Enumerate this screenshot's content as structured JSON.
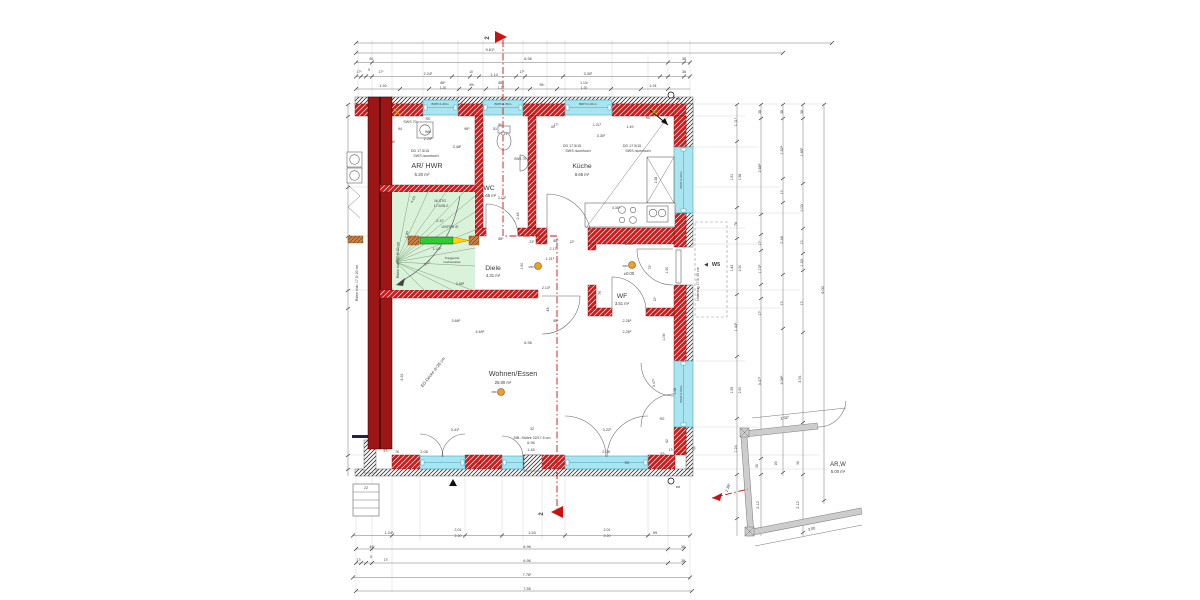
{
  "colors": {
    "wall_red": "#cf1b1b",
    "party_wall": "#9c1616",
    "window_cyan": "#a9e5f0",
    "window_frame": "#43a7bd",
    "stair_green": "#d9f2d9",
    "lintel_green": "#2ecc2e",
    "lintel_yellow": "#ffd400",
    "bearing_brown": "#c8834a",
    "smoke_detector_orange": "#f09e2e",
    "section_red": "#cc1111",
    "fragment_wall_gray": "#cdcdcd",
    "dim_line": "#666666",
    "text": "#3a3a3a"
  },
  "labels": {
    "rooms": [
      {
        "t": "AR/ HWR",
        "x": 427,
        "y": 168,
        "s": 7.2
      },
      {
        "t": "6.20 m²",
        "x": 422,
        "y": 176,
        "s": 4.4
      },
      {
        "t": "WC",
        "x": 489,
        "y": 190,
        "s": 6.8
      },
      {
        "t": "1.65 m²",
        "x": 489,
        "y": 197,
        "s": 4.2
      },
      {
        "t": "Küche",
        "x": 582,
        "y": 168,
        "s": 6.8
      },
      {
        "t": "8.66 m²",
        "x": 582,
        "y": 176,
        "s": 4.2
      },
      {
        "t": "Diele",
        "x": 493,
        "y": 270,
        "s": 6.8
      },
      {
        "t": "4.31 m²",
        "x": 493,
        "y": 277,
        "s": 4.2
      },
      {
        "t": "WF",
        "x": 622,
        "y": 298,
        "s": 6.8
      },
      {
        "t": "3.51 m²",
        "x": 622,
        "y": 305,
        "s": 4.2
      },
      {
        "t": "Wohnen/Essen",
        "x": 513,
        "y": 376,
        "s": 7.2
      },
      {
        "t": "25.90 m²",
        "x": 503,
        "y": 384,
        "s": 4.2
      },
      {
        "t": "AR,W",
        "x": 838,
        "y": 466,
        "s": 6
      },
      {
        "t": "5.00 m²",
        "x": 838,
        "y": 473,
        "s": 4.2
      }
    ],
    "annotations": [
      {
        "t": "SWS 70",
        "x": 410,
        "y": 123,
        "s": 3.6
      },
      {
        "t": "RO",
        "x": 428,
        "y": 120,
        "s": 3.2
      },
      {
        "t": "WM",
        "x": 428,
        "y": 133,
        "s": 3.4
      },
      {
        "t": "DD 17.5/15",
        "x": 420,
        "y": 152,
        "s": 3.6
      },
      {
        "t": "SWS raumhoch",
        "x": 426,
        "y": 157,
        "s": 3.6
      },
      {
        "t": "DD 17.5/15",
        "x": 572,
        "y": 147,
        "s": 3.6
      },
      {
        "t": "SWS raumhoch",
        "x": 578,
        "y": 152,
        "s": 3.6
      },
      {
        "t": "DD 17.5/15",
        "x": 632,
        "y": 147,
        "s": 3.6
      },
      {
        "t": "SWS raumhoch",
        "x": 638,
        "y": 152,
        "s": 3.6
      },
      {
        "t": "SWS 70",
        "x": 520,
        "y": 160,
        "s": 3.2
      },
      {
        "t": "BRH=1.00m",
        "x": 440,
        "y": 105,
        "s": 3.1
      },
      {
        "t": "BRH=1.50m",
        "x": 503,
        "y": 105,
        "s": 3.1
      },
      {
        "t": "BRH=1.00 m",
        "x": 588,
        "y": 105,
        "s": 3.1
      },
      {
        "t": "BRH=1.00m",
        "x": 682,
        "y": 180,
        "s": 3.1,
        "r": -90
      },
      {
        "t": "BRH=1.00m",
        "x": 682,
        "y": 394,
        "s": 3.1,
        "r": -90
      },
      {
        "t": "RO",
        "x": 648,
        "y": 119,
        "s": 3.2
      },
      {
        "t": "RO",
        "x": 479,
        "y": 464,
        "s": 3.2
      },
      {
        "t": "RO",
        "x": 627,
        "y": 464,
        "s": 3.2
      },
      {
        "t": "RO",
        "x": 662,
        "y": 420,
        "s": 3.2
      },
      {
        "t": "16 STG",
        "x": 440,
        "y": 202,
        "s": 3.5
      },
      {
        "t": "17.9/26.0",
        "x": 441,
        "y": 207,
        "s": 3.5
      },
      {
        "t": "2.47",
        "x": 440,
        "y": 222,
        "s": 3.8
      },
      {
        "t": "UV/FBH /E",
        "x": 450,
        "y": 228,
        "s": 3.5
      },
      {
        "t": "Traggerüst",
        "x": 452,
        "y": 259,
        "s": 3.1
      },
      {
        "t": "nachweisbar",
        "x": 452,
        "y": 263,
        "s": 3.1
      },
      {
        "t": "Rähm b/d= 17.5/ 20 cm",
        "x": 358,
        "y": 283,
        "s": 3.5,
        "r": -90
      },
      {
        "t": "Rähm b/d= 17.5/ 20 cm",
        "x": 399,
        "y": 260,
        "s": 3.5,
        "r": -90
      },
      {
        "t": "Unterzug 17.5/ 45 cm",
        "x": 699,
        "y": 284,
        "s": 3.5,
        "r": -90
      },
      {
        "t": "EG-Decke d=20 cm",
        "x": 434,
        "y": 373,
        "s": 4.2,
        "r": -52
      },
      {
        "t": "32",
        "x": 532,
        "y": 430,
        "s": 3.6
      },
      {
        "t": "StB.-Stütze 32/17.5 cm",
        "x": 532,
        "y": 439,
        "s": 3.6
      },
      {
        "t": "±0.00",
        "x": 629,
        "y": 275,
        "s": 4.2
      },
      {
        "t": "RM",
        "x": 531,
        "y": 268,
        "s": 3.1
      },
      {
        "t": "RM",
        "x": 625,
        "y": 267,
        "s": 3.1
      },
      {
        "t": "RM",
        "x": 494,
        "y": 393,
        "s": 3.1
      },
      {
        "t": "RR",
        "x": 678,
        "y": 100,
        "s": 3.1
      },
      {
        "t": "RR",
        "x": 678,
        "y": 488,
        "s": 3.1
      }
    ],
    "dims_plan": [
      {
        "t": "94",
        "x": 400,
        "y": 130,
        "s": 3.6
      },
      {
        "t": "96⁵",
        "x": 467,
        "y": 130,
        "s": 3.6
      },
      {
        "t": "51",
        "x": 495,
        "y": 130,
        "s": 3.6
      },
      {
        "t": "78",
        "x": 385,
        "y": 133,
        "s": 3.4
      },
      {
        "t": "2.24¹",
        "x": 428,
        "y": 140,
        "s": 3.8
      },
      {
        "t": "50",
        "x": 393,
        "y": 143,
        "s": 3.4
      },
      {
        "t": "3.48¹",
        "x": 457,
        "y": 148,
        "s": 3.8
      },
      {
        "t": "96",
        "x": 500,
        "y": 126,
        "s": 3.2
      },
      {
        "t": "1.14",
        "x": 504,
        "y": 135,
        "s": 3.2
      },
      {
        "t": "60",
        "x": 553,
        "y": 128,
        "s": 3.2
      },
      {
        "t": "1.21¹",
        "x": 597,
        "y": 126,
        "s": 3.6
      },
      {
        "t": "1.49",
        "x": 630,
        "y": 128,
        "s": 3.6
      },
      {
        "t": "3.30¹",
        "x": 601,
        "y": 137,
        "s": 3.8
      },
      {
        "t": "17⁵",
        "x": 556,
        "y": 126,
        "s": 3.2
      },
      {
        "t": "4.30¹",
        "x": 616,
        "y": 209,
        "s": 3.6
      },
      {
        "t": "2.38",
        "x": 657,
        "y": 180,
        "s": 3.4,
        "r": -90
      },
      {
        "t": "88⁵",
        "x": 501,
        "y": 240,
        "s": 3.4
      },
      {
        "t": "2.13¹",
        "x": 502,
        "y": 199,
        "s": 3.6
      },
      {
        "t": "2.48",
        "x": 519,
        "y": 216,
        "s": 3.6,
        "r": -90
      },
      {
        "t": "4.15",
        "x": 414,
        "y": 200,
        "s": 3.6,
        "r": -62
      },
      {
        "t": "1.90",
        "x": 408,
        "y": 235,
        "s": 3.6,
        "r": -78
      },
      {
        "t": "2.27",
        "x": 428,
        "y": 264,
        "s": 3.6,
        "r": -33
      },
      {
        "t": "1.14¹",
        "x": 437,
        "y": 250,
        "s": 3.8
      },
      {
        "t": "3.68⁵",
        "x": 460,
        "y": 285,
        "s": 3.6
      },
      {
        "t": "23⁵",
        "x": 532,
        "y": 243,
        "s": 3.4
      },
      {
        "t": "88⁵",
        "x": 556,
        "y": 242,
        "s": 3.4
      },
      {
        "t": "12⁵",
        "x": 572,
        "y": 243,
        "s": 3.2
      },
      {
        "t": "2.17",
        "x": 553,
        "y": 250,
        "s": 3.6
      },
      {
        "t": "1.21⁵",
        "x": 550,
        "y": 260,
        "s": 3.6
      },
      {
        "t": "1.50",
        "x": 523,
        "y": 266,
        "s": 3.4,
        "r": -90
      },
      {
        "t": "2.13¹",
        "x": 546,
        "y": 289,
        "s": 3.6
      },
      {
        "t": "43¹",
        "x": 549,
        "y": 309,
        "s": 3.4,
        "r": -90
      },
      {
        "t": "79",
        "x": 601,
        "y": 293,
        "s": 3.4,
        "r": -90
      },
      {
        "t": "2.09",
        "x": 629,
        "y": 245,
        "s": 3.8
      },
      {
        "t": "73⁵",
        "x": 651,
        "y": 267,
        "s": 3.3,
        "r": -90
      },
      {
        "t": "1.50",
        "x": 668,
        "y": 270,
        "s": 3.4,
        "r": -90
      },
      {
        "t": "12⁵",
        "x": 656,
        "y": 299,
        "s": 3.3,
        "r": -90
      },
      {
        "t": "3.68⁵",
        "x": 456,
        "y": 322,
        "s": 3.8
      },
      {
        "t": "88⁵",
        "x": 556,
        "y": 322,
        "s": 3.4
      },
      {
        "t": "2.26⁵",
        "x": 627,
        "y": 322,
        "s": 3.8
      },
      {
        "t": "4.69⁵",
        "x": 480,
        "y": 333,
        "s": 3.8
      },
      {
        "t": "2.26⁵",
        "x": 627,
        "y": 333,
        "s": 3.8
      },
      {
        "t": "6.96",
        "x": 528,
        "y": 344,
        "s": 3.8
      },
      {
        "t": "3.91",
        "x": 403,
        "y": 377,
        "s": 3.8,
        "r": -90
      },
      {
        "t": "1.06¹",
        "x": 665,
        "y": 337,
        "s": 3.4,
        "r": -90
      },
      {
        "t": "3.47¹",
        "x": 655,
        "y": 383,
        "s": 3.6,
        "r": -90
      },
      {
        "t": "1.58",
        "x": 676,
        "y": 391,
        "s": 3.4,
        "r": -90
      },
      {
        "t": "3.41¹",
        "x": 455,
        "y": 431,
        "s": 3.8
      },
      {
        "t": "3.22¹",
        "x": 607,
        "y": 431,
        "s": 3.8
      },
      {
        "t": "6.96",
        "x": 531,
        "y": 444,
        "s": 3.8
      },
      {
        "t": "1.45",
        "x": 531,
        "y": 451,
        "s": 3.8
      },
      {
        "t": "2.08",
        "x": 424,
        "y": 453,
        "s": 3.8
      },
      {
        "t": "2.08",
        "x": 606,
        "y": 453,
        "s": 3.8
      },
      {
        "t": "57¹",
        "x": 386,
        "y": 452,
        "s": 3.4
      },
      {
        "t": "76",
        "x": 397,
        "y": 453,
        "s": 3.4
      },
      {
        "t": "57¹",
        "x": 663,
        "y": 455,
        "s": 3.4
      },
      {
        "t": "17¹",
        "x": 671,
        "y": 451,
        "s": 3.2
      },
      {
        "t": "20¹",
        "x": 695,
        "y": 449,
        "s": 3.4,
        "r": -60
      },
      {
        "t": "62",
        "x": 668,
        "y": 441,
        "s": 3.2,
        "r": -90
      },
      {
        "t": "22",
        "x": 366,
        "y": 489,
        "s": 3.6
      }
    ],
    "dims_top": [
      {
        "t": "9.61¹",
        "x": 490,
        "y": 51,
        "s": 4
      },
      {
        "t": "40",
        "x": 371,
        "y": 60,
        "s": 3.6
      },
      {
        "t": "6.96",
        "x": 528,
        "y": 60,
        "s": 3.8
      },
      {
        "t": "38",
        "x": 684,
        "y": 60,
        "s": 3.6
      },
      {
        "t": "17⁵",
        "x": 359,
        "y": 73,
        "s": 3.3
      },
      {
        "t": "5",
        "x": 369,
        "y": 71,
        "s": 3.3
      },
      {
        "t": "17⁵",
        "x": 381,
        "y": 73,
        "s": 3.3
      },
      {
        "t": "2.24¹",
        "x": 428,
        "y": 75,
        "s": 3.8
      },
      {
        "t": "10",
        "x": 471,
        "y": 73,
        "s": 3.4
      },
      {
        "t": "1.14",
        "x": 494,
        "y": 76,
        "s": 3.8
      },
      {
        "t": "17⁵",
        "x": 522,
        "y": 73,
        "s": 3.3
      },
      {
        "t": "3.30¹",
        "x": 588,
        "y": 75,
        "s": 3.8
      },
      {
        "t": "38",
        "x": 684,
        "y": 73,
        "s": 3.6
      },
      {
        "t": "1.92",
        "x": 383,
        "y": 87,
        "s": 3.8
      },
      {
        "t": "88⁵",
        "x": 443,
        "y": 84,
        "s": 3.4
      },
      {
        "t": "1.20",
        "x": 443,
        "y": 89,
        "s": 3.4
      },
      {
        "t": "59¹",
        "x": 472,
        "y": 86,
        "s": 3.4
      },
      {
        "t": "88⁵",
        "x": 501,
        "y": 84,
        "s": 3.4
      },
      {
        "t": "1.20",
        "x": 501,
        "y": 89,
        "s": 3.4
      },
      {
        "t": "95¹",
        "x": 542,
        "y": 86,
        "s": 3.4
      },
      {
        "t": "1.13²",
        "x": 584,
        "y": 84,
        "s": 3.4
      },
      {
        "t": "1.20",
        "x": 584,
        "y": 89,
        "s": 3.4
      },
      {
        "t": "1.91",
        "x": 653,
        "y": 87,
        "s": 3.8
      }
    ],
    "dims_bottom": [
      {
        "t": "1.24¹",
        "x": 389,
        "y": 534,
        "s": 3.8
      },
      {
        "t": "2.01",
        "x": 458,
        "y": 531,
        "s": 3.6
      },
      {
        "t": "2.20",
        "x": 458,
        "y": 537,
        "s": 3.6
      },
      {
        "t": "1.53",
        "x": 532,
        "y": 534,
        "s": 3.8
      },
      {
        "t": "2.01",
        "x": 607,
        "y": 531,
        "s": 3.6
      },
      {
        "t": "2.20",
        "x": 607,
        "y": 537,
        "s": 3.6
      },
      {
        "t": "99",
        "x": 655,
        "y": 534,
        "s": 3.8
      },
      {
        "t": "44¹",
        "x": 372,
        "y": 548,
        "s": 3.6
      },
      {
        "t": "6.96",
        "x": 527,
        "y": 548,
        "s": 3.8
      },
      {
        "t": "38",
        "x": 683,
        "y": 548,
        "s": 3.6
      },
      {
        "t": "17¹",
        "x": 359,
        "y": 561,
        "s": 3.3
      },
      {
        "t": "5",
        "x": 371,
        "y": 558,
        "s": 3.3
      },
      {
        "t": "17¹",
        "x": 386,
        "y": 561,
        "s": 3.3
      },
      {
        "t": "6.96",
        "x": 527,
        "y": 562,
        "s": 3.8
      },
      {
        "t": "38",
        "x": 683,
        "y": 562,
        "s": 3.6
      },
      {
        "t": "7.76¹",
        "x": 527,
        "y": 576,
        "s": 3.8
      },
      {
        "t": "7.55",
        "x": 527,
        "y": 590,
        "s": 3.8
      }
    ],
    "dims_right": [
      {
        "t": "1.11¹",
        "x": 737,
        "y": 122,
        "s": 3.8,
        "r": -90
      },
      {
        "t": "1.51",
        "x": 733,
        "y": 177,
        "s": 3.4,
        "r": -90
      },
      {
        "t": "1.58",
        "x": 741,
        "y": 177,
        "s": 3.4,
        "r": -90
      },
      {
        "t": "76",
        "x": 737,
        "y": 224,
        "s": 3.6,
        "r": -90
      },
      {
        "t": "1.43",
        "x": 733,
        "y": 268,
        "s": 3.4,
        "r": -90
      },
      {
        "t": "2.50",
        "x": 741,
        "y": 268,
        "s": 3.4,
        "r": -90
      },
      {
        "t": "1.44¹",
        "x": 737,
        "y": 327,
        "s": 3.8,
        "r": -90
      },
      {
        "t": "1.55",
        "x": 733,
        "y": 390,
        "s": 3.4,
        "r": -90
      },
      {
        "t": "2.50",
        "x": 741,
        "y": 390,
        "s": 3.4,
        "r": -90
      },
      {
        "t": "1.24",
        "x": 737,
        "y": 449,
        "s": 3.8,
        "r": -90
      },
      {
        "t": "38",
        "x": 761,
        "y": 112,
        "s": 3.4,
        "r": -90
      },
      {
        "t": "2.68⁵",
        "x": 761,
        "y": 168,
        "s": 3.8,
        "r": -90
      },
      {
        "t": "17⁵",
        "x": 761,
        "y": 243,
        "s": 3.3,
        "r": -90
      },
      {
        "t": "1.73⁵",
        "x": 761,
        "y": 269,
        "s": 3.8,
        "r": -90
      },
      {
        "t": "17⁵",
        "x": 761,
        "y": 313,
        "s": 3.3,
        "r": -90
      },
      {
        "t": "3.47¹",
        "x": 761,
        "y": 381,
        "s": 3.8,
        "r": -90
      },
      {
        "t": "38",
        "x": 758,
        "y": 466,
        "s": 3.3,
        "r": -90
      },
      {
        "t": "2.12",
        "x": 759,
        "y": 505,
        "s": 3.8,
        "r": -90
      },
      {
        "t": "38",
        "x": 783,
        "y": 112,
        "s": 3.4,
        "r": -90
      },
      {
        "t": "1.52⁵",
        "x": 783,
        "y": 150,
        "s": 3.8,
        "r": -90
      },
      {
        "t": "17¹",
        "x": 783,
        "y": 192,
        "s": 3.3,
        "r": -90
      },
      {
        "t": "2.48",
        "x": 783,
        "y": 240,
        "s": 3.8,
        "r": -90
      },
      {
        "t": "17¹",
        "x": 783,
        "y": 303,
        "s": 3.3,
        "r": -90
      },
      {
        "t": "4.08⁵",
        "x": 783,
        "y": 380,
        "s": 3.8,
        "r": -90
      },
      {
        "t": "20¹",
        "x": 777,
        "y": 463,
        "s": 3.3,
        "r": -90
      },
      {
        "t": "38",
        "x": 803,
        "y": 112,
        "s": 3.4,
        "r": -90
      },
      {
        "t": "1.65¹",
        "x": 803,
        "y": 152,
        "s": 3.8,
        "r": -90
      },
      {
        "t": "1.03",
        "x": 803,
        "y": 208,
        "s": 3.8,
        "r": -90
      },
      {
        "t": "17¹",
        "x": 803,
        "y": 242,
        "s": 3.3,
        "r": -90
      },
      {
        "t": "1.30",
        "x": 803,
        "y": 263,
        "s": 3.8,
        "r": -90
      },
      {
        "t": "17¹",
        "x": 803,
        "y": 303,
        "s": 3.3,
        "r": -90
      },
      {
        "t": "3.91",
        "x": 801,
        "y": 379,
        "s": 3.8,
        "r": -90
      },
      {
        "t": "38",
        "x": 799,
        "y": 463,
        "s": 3.3,
        "r": -90
      },
      {
        "t": "2.12",
        "x": 799,
        "y": 505,
        "s": 3.8,
        "r": -90
      },
      {
        "t": "9.00",
        "x": 824,
        "y": 290,
        "s": 3.8,
        "r": -90
      }
    ],
    "fragment": [
      {
        "t": "2.92⁵",
        "x": 785,
        "y": 419,
        "s": 3.8,
        "r": -9
      },
      {
        "t": "3.00",
        "x": 812,
        "y": 530,
        "s": 3.8,
        "r": -13
      },
      {
        "t": "2.39⁵",
        "x": 729,
        "y": 488,
        "s": 3.8,
        "r": -70
      }
    ],
    "markers": [
      {
        "t": "2",
        "x": 489,
        "y": 38,
        "s": 6,
        "r": -90,
        "c": "#cc1111",
        "b": true
      },
      {
        "t": "2",
        "x": 543,
        "y": 514,
        "s": 6,
        "r": -90,
        "c": "#cc1111",
        "b": true
      },
      {
        "t": "4",
        "x": 721,
        "y": 496,
        "s": 4.5,
        "c": "#cc1111"
      },
      {
        "t": "◀",
        "x": 706,
        "y": 266,
        "s": 5
      },
      {
        "t": "W5",
        "x": 716,
        "y": 266,
        "s": 5.5,
        "b": true
      }
    ]
  }
}
